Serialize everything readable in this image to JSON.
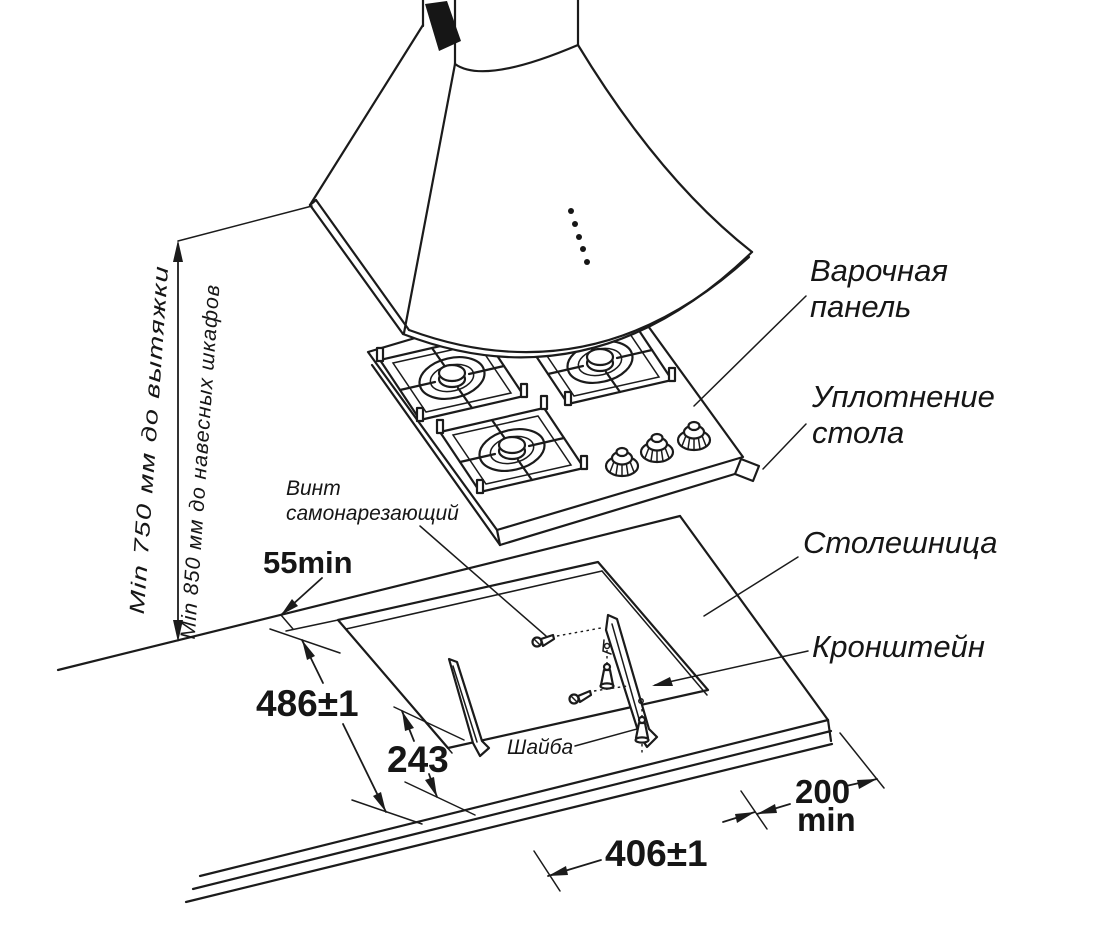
{
  "diagram": {
    "labels": {
      "clearance_hood": "Min 750 мм до вытяжки",
      "clearance_cabinets": "Min 850 мм до навесных шкафов",
      "panel_line1": "Варочная",
      "panel_line2": "панель",
      "seal_line1": "Уплотнение",
      "seal_line2": "стола",
      "countertop": "Столешница",
      "bracket": "Кронштейн",
      "screw_line1": "Винт",
      "screw_line2": "самонарезающий",
      "washer": "Шайба"
    },
    "dimensions": {
      "rear_gap": "55min",
      "cutout_depth": "486±1",
      "bracket_offset": "243",
      "cutout_width": "406±1",
      "side_margin_value": "200",
      "side_margin_unit": "min"
    }
  }
}
